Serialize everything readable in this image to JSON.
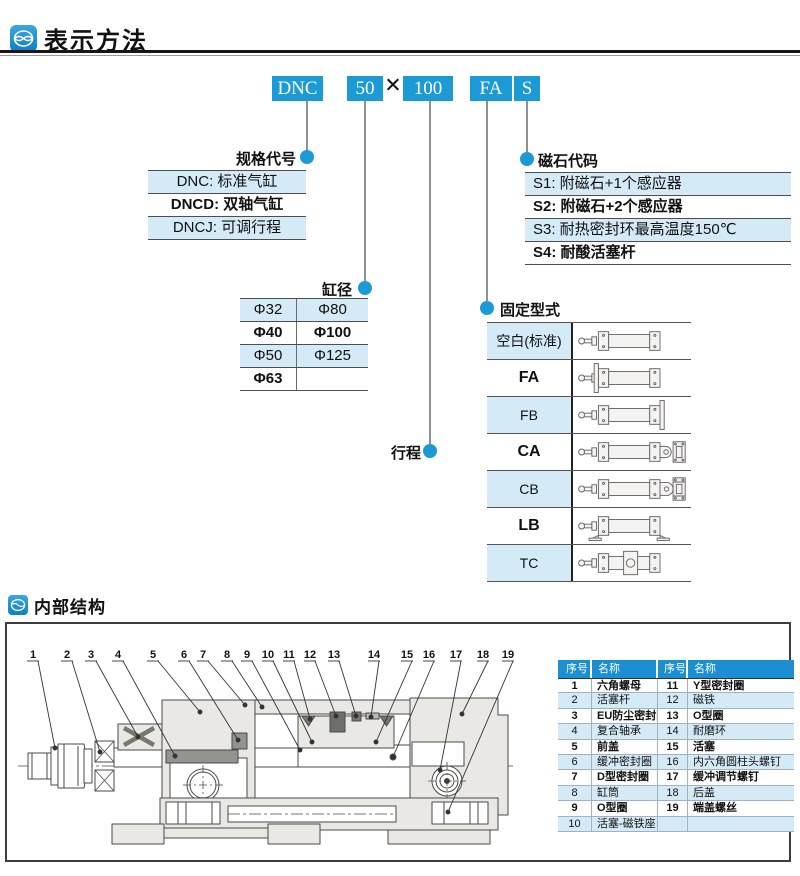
{
  "header": {
    "title": "表示方法"
  },
  "model_code": {
    "prefix": "DNC",
    "bore": "50",
    "times": "×",
    "stroke": "100",
    "mount": "FA",
    "magnet": "S"
  },
  "callout_labels": {
    "spec": "规格代号",
    "bore": "缸径",
    "stroke": "行程",
    "magnet": "磁石代码",
    "mount": "固定型式"
  },
  "spec_table": {
    "rows": [
      {
        "text": "DNC: 标准气缸"
      },
      {
        "text": "DNCD: 双轴气缸"
      },
      {
        "text": "DNCJ: 可调行程"
      }
    ]
  },
  "bore_table": {
    "rows": [
      {
        "c1": "Φ32",
        "c2": "Φ80"
      },
      {
        "c1": "Φ40",
        "c2": "Φ100"
      },
      {
        "c1": "Φ50",
        "c2": "Φ125"
      },
      {
        "c1": "Φ63",
        "c2": ""
      }
    ]
  },
  "magnet_table": {
    "rows": [
      {
        "text": "S1: 附磁石+1个感应器"
      },
      {
        "text": "S2: 附磁石+2个感应器"
      },
      {
        "text": "S3: 耐热密封环最高温度150℃"
      },
      {
        "text": "S4: 耐酸活塞杆"
      }
    ]
  },
  "mount_table": {
    "rows": [
      {
        "code": "空白(标准)",
        "icon": "cyl-basic"
      },
      {
        "code": "FA",
        "icon": "cyl-flange-front"
      },
      {
        "code": "FB",
        "icon": "cyl-flange-rear"
      },
      {
        "code": "CA",
        "icon": "cyl-clevis-single"
      },
      {
        "code": "CB",
        "icon": "cyl-clevis-double"
      },
      {
        "code": "LB",
        "icon": "cyl-foot"
      },
      {
        "code": "TC",
        "icon": "cyl-trunnion"
      }
    ]
  },
  "internal": {
    "title": "内部结构",
    "callouts": [
      "1",
      "2",
      "3",
      "4",
      "5",
      "6",
      "7",
      "8",
      "9",
      "10",
      "11",
      "12",
      "13",
      "14",
      "15",
      "16",
      "17",
      "18",
      "19"
    ]
  },
  "parts_table": {
    "headers": [
      "序号",
      "名称",
      "序号",
      "名称"
    ],
    "rows": [
      [
        "1",
        "六角螺母",
        "11",
        "Y型密封圈"
      ],
      [
        "2",
        "活塞杆",
        "12",
        "磁铁"
      ],
      [
        "3",
        "EU防尘密封圈",
        "13",
        "O型圈"
      ],
      [
        "4",
        "复合轴承",
        "14",
        "耐磨环"
      ],
      [
        "5",
        "前盖",
        "15",
        "活塞"
      ],
      [
        "6",
        "缓冲密封圈",
        "16",
        "内六角圆柱头螺钉"
      ],
      [
        "7",
        "D型密封圈",
        "17",
        "缓冲调节螺钉"
      ],
      [
        "8",
        "缸筒",
        "18",
        "后盖"
      ],
      [
        "9",
        "O型圈",
        "19",
        "端盖螺丝"
      ],
      [
        "10",
        "活塞-磁铁座",
        "",
        ""
      ]
    ]
  },
  "colors": {
    "accent": "#1b9ad6",
    "row_highlight": "#d5eaf7",
    "table_header_bg": "#1b8fd2"
  }
}
